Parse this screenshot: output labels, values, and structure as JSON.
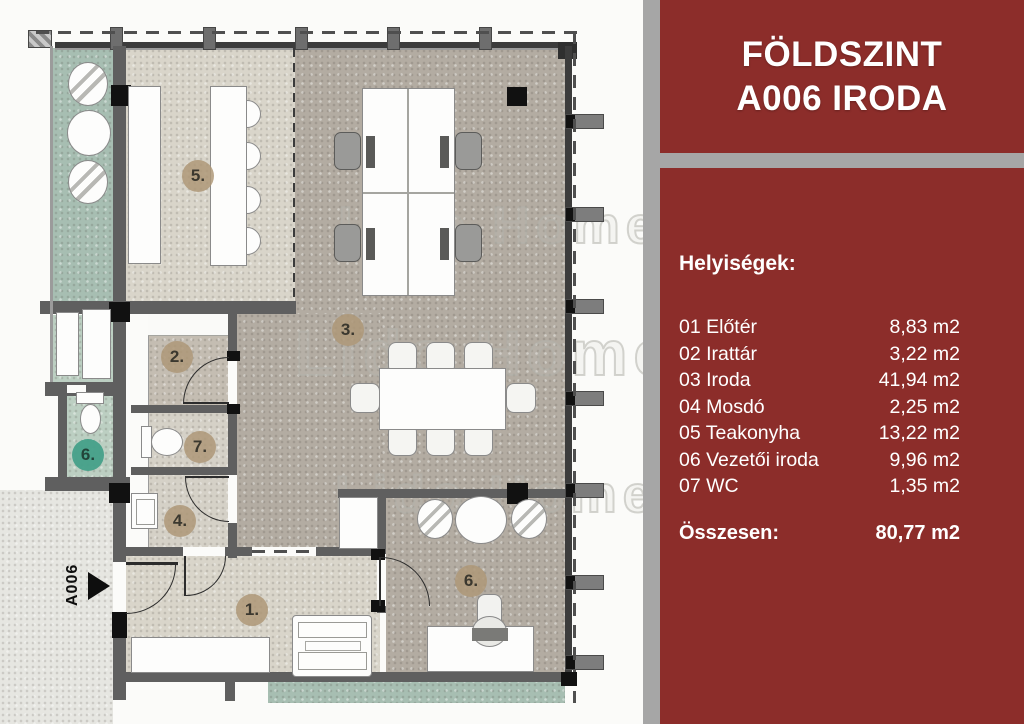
{
  "panel": {
    "title": {
      "line1": "FÖLDSZINT",
      "line2": "A006 IRODA"
    },
    "section_heading": "Helyiségek:",
    "rooms": [
      {
        "label": "01 Előtér",
        "area": "8,83 m2"
      },
      {
        "label": "02 Irattár",
        "area": "3,22 m2"
      },
      {
        "label": "03 Iroda",
        "area": "41,94 m2"
      },
      {
        "label": "04 Mosdó",
        "area": "2,25 m2"
      },
      {
        "label": "05 Teakonyha",
        "area": "13,22 m2"
      },
      {
        "label": "06 Vezetői iroda",
        "area": "9,96 m2"
      },
      {
        "label": "07 WC",
        "area": "1,35 m2"
      }
    ],
    "total": {
      "label": "Összesen:",
      "area": "80,77 m2"
    },
    "colors": {
      "panel_red": "#8C2D2A",
      "panel_gray": "#A6A6A6",
      "text": "#FFFFFF"
    }
  },
  "plan": {
    "entrance_label": "A006",
    "watermark": "Lido Home",
    "badges": [
      {
        "label": "5.",
        "color": "#AE9878"
      },
      {
        "label": "3.",
        "color": "#AE9878"
      },
      {
        "label": "2.",
        "color": "#AE9878"
      },
      {
        "label": "7.",
        "color": "#AE9878"
      },
      {
        "label": "4.",
        "color": "#AE9878"
      },
      {
        "label": "1.",
        "color": "#AE9878"
      },
      {
        "label": "6.",
        "color": "#AE9878"
      },
      {
        "label": "6.",
        "color": "#44A089"
      }
    ],
    "floor_colors": {
      "office": "#B3ACA2",
      "kitchen": "#D9D5CA",
      "terrace": "#A7BEB2",
      "exterior": "#E6E6E1"
    }
  }
}
